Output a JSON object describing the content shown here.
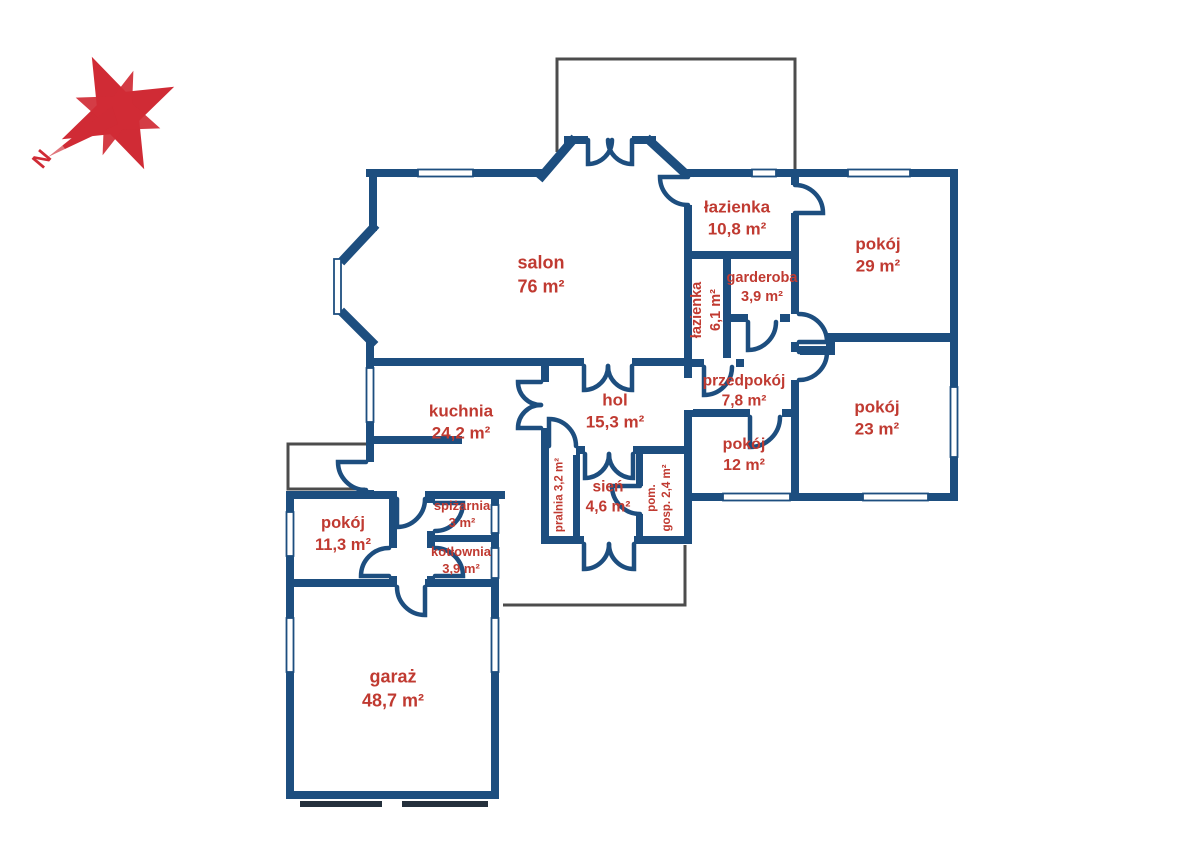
{
  "colors": {
    "wall": "#1d4e7f",
    "label": "#c03a31",
    "compass": "#d02b35",
    "outline": "#4c4c4c",
    "garage_door": "#24303c"
  },
  "compass": {
    "north_label": "N"
  },
  "rooms": [
    {
      "id": "salon",
      "name": "salon",
      "area": "76 m²",
      "x": 541,
      "y": 275,
      "rotate": 0,
      "size": 18,
      "layout": "stack"
    },
    {
      "id": "lazienka-duza",
      "name": "łazienka",
      "area": "10,8 m²",
      "x": 737,
      "y": 219,
      "rotate": 0,
      "size": 17,
      "layout": "stack"
    },
    {
      "id": "pokoj-29",
      "name": "pokój",
      "area": "29 m²",
      "x": 878,
      "y": 256,
      "rotate": 0,
      "size": 17,
      "layout": "stack"
    },
    {
      "id": "garderoba",
      "name": "garderoba",
      "area": "3,9 m²",
      "x": 762,
      "y": 288,
      "rotate": 0,
      "size": 14.5,
      "layout": "stack"
    },
    {
      "id": "lazienka-mala",
      "name": "łazienka",
      "area": "6,1 m²",
      "x": 707,
      "y": 310,
      "rotate": -90,
      "size": 14.5,
      "layout": "stack"
    },
    {
      "id": "przedpokoj",
      "name": "przedpokój",
      "area": "7,8 m²",
      "x": 744,
      "y": 392,
      "rotate": 0,
      "size": 15.5,
      "layout": "stack"
    },
    {
      "id": "pokoj-23",
      "name": "pokój",
      "area": "23 m²",
      "x": 877,
      "y": 419,
      "rotate": 0,
      "size": 17,
      "layout": "stack"
    },
    {
      "id": "pokoj-12",
      "name": "pokój",
      "area": "12 m²",
      "x": 744,
      "y": 455,
      "rotate": 0,
      "size": 16,
      "layout": "stack"
    },
    {
      "id": "hol",
      "name": "hol",
      "area": "15,3 m²",
      "x": 615,
      "y": 412,
      "rotate": 0,
      "size": 17,
      "layout": "stack"
    },
    {
      "id": "kuchnia",
      "name": "kuchnia",
      "area": "24,2 m²",
      "x": 461,
      "y": 423,
      "rotate": 0,
      "size": 17,
      "layout": "stack"
    },
    {
      "id": "sien",
      "name": "sień",
      "area": "4,6 m²",
      "x": 608,
      "y": 498,
      "rotate": 0,
      "size": 15.5,
      "layout": "stack"
    },
    {
      "id": "pralnia",
      "name": "pralnia",
      "area": "3,2 m²",
      "x": 560,
      "y": 495,
      "rotate": -90,
      "size": 11.5,
      "layout": "inline"
    },
    {
      "id": "pom-gosp",
      "name": "pom.",
      "area": "gosp. 2,4 m²",
      "x": 660,
      "y": 498,
      "rotate": -90,
      "size": 11.5,
      "layout": "stack"
    },
    {
      "id": "spizarnia",
      "name": "spiżarnia",
      "area": "3 m²",
      "x": 462,
      "y": 514,
      "rotate": 0,
      "size": 13,
      "layout": "stack"
    },
    {
      "id": "kotlownia",
      "name": "kotłownia",
      "area": "3,9 m²",
      "x": 461,
      "y": 560,
      "rotate": 0,
      "size": 13,
      "layout": "stack"
    },
    {
      "id": "pokoj-11",
      "name": "pokój",
      "area": "11,3 m²",
      "x": 343,
      "y": 535,
      "rotate": 0,
      "size": 16.5,
      "layout": "stack"
    },
    {
      "id": "garaz",
      "name": "garaż",
      "area": "48,7 m²",
      "x": 393,
      "y": 689,
      "rotate": 0,
      "size": 18,
      "layout": "stack"
    }
  ]
}
